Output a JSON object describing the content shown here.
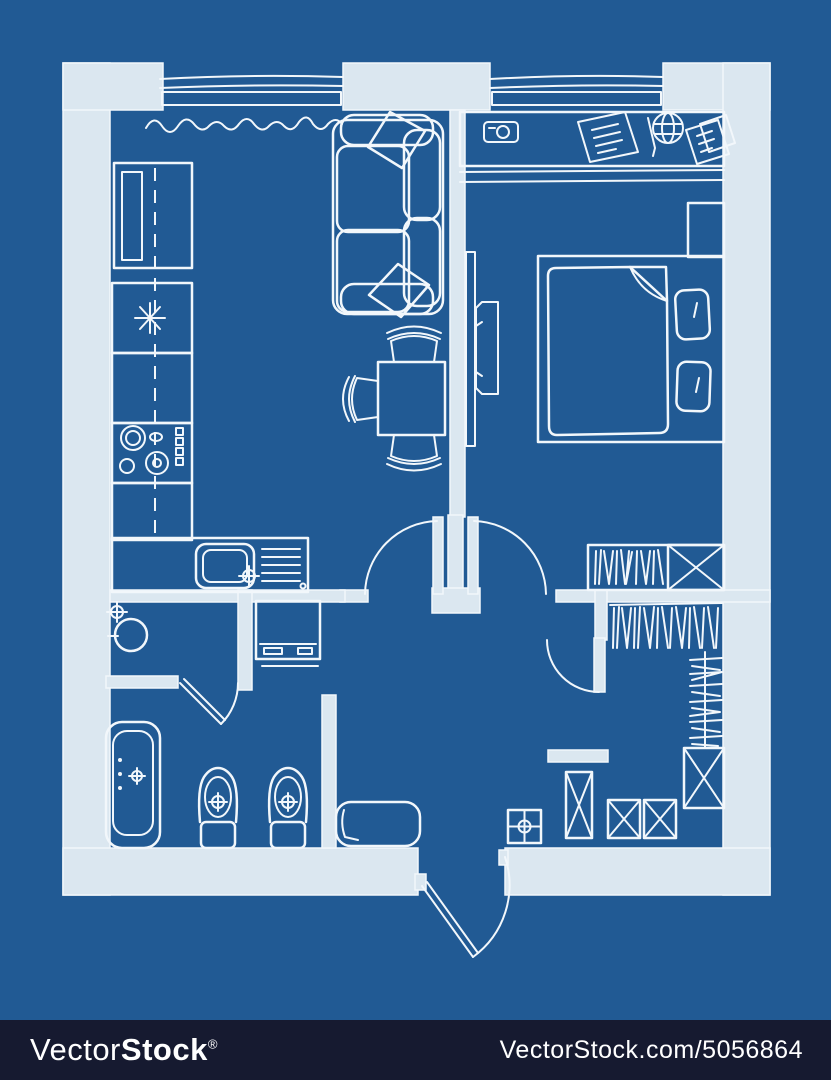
{
  "image": {
    "kind": "hand-drawn apartment floor plan, top view",
    "style": "white sketch lines and light walls on a blue blueprint background"
  },
  "colors": {
    "background": "#215a94",
    "wall": "#dbe7f0",
    "line": "#f2f7fb",
    "watermark_bar": "#161a30",
    "watermark_text": "#ffffff"
  },
  "watermark": {
    "brand_regular": "Vector",
    "brand_bold": "Stock",
    "registered_mark": "®",
    "url_text": "VectorStock.com/5056864"
  },
  "floor_plan": {
    "rooms": [
      {
        "name": "kitchen",
        "furniture": [
          "tall-cabinet",
          "fridge",
          "cooktop",
          "counter",
          "sink-with-drainer",
          "curtain"
        ]
      },
      {
        "name": "living-room",
        "furniture": [
          "sofa",
          "sofa-pillows",
          "dining-table",
          "three-chairs",
          "wall-tv"
        ]
      },
      {
        "name": "bedroom",
        "furniture": [
          "desk",
          "camera",
          "paper",
          "pen",
          "globe",
          "papers",
          "nightstand",
          "double-bed",
          "blanket",
          "two-pillows",
          "wardrobe-with-hangers",
          "shelf-box"
        ]
      },
      {
        "name": "bathroom",
        "furniture": [
          "washbasin",
          "bathtub",
          "toilet",
          "bidet",
          "washing-machine"
        ]
      },
      {
        "name": "hallway",
        "furniture": [
          "bench",
          "side-table"
        ]
      },
      {
        "name": "walk-in-closet",
        "furniture": [
          "clothes-rail-top",
          "clothes-rail-side",
          "shelf-boxes"
        ]
      }
    ],
    "features": [
      "two-windows-top",
      "living-room-door",
      "bedroom-door",
      "bathroom-door",
      "closet-door",
      "entrance-door"
    ]
  }
}
